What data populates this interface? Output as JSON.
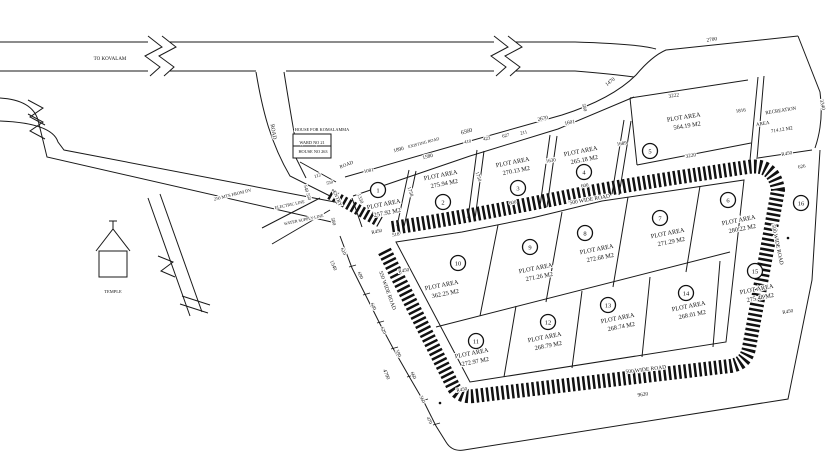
{
  "drawing_type": "land-subdivision-site-plan",
  "colors": {
    "ink": "#1a1a1a",
    "paper": "#ffffff"
  },
  "plot_area_label": "PLOT AREA",
  "plots": [
    {
      "n": "1",
      "area": "257.92 M2",
      "cx": 378,
      "cy": 190,
      "tx": 384,
      "ty": 206,
      "rot": -11
    },
    {
      "n": "2",
      "area": "275.94 M2",
      "cx": 443,
      "cy": 202,
      "tx": 441,
      "ty": 177,
      "rot": -11
    },
    {
      "n": "3",
      "area": "270.13 M2",
      "cx": 518,
      "cy": 188,
      "tx": 513,
      "ty": 164,
      "rot": -11
    },
    {
      "n": "4",
      "area": "265.18 M2",
      "cx": 584,
      "cy": 172,
      "tx": 581,
      "ty": 153,
      "rot": -11
    },
    {
      "n": "5",
      "area": "564.19 M2",
      "cx": 650,
      "cy": 151,
      "tx": 684,
      "ty": 119,
      "rot": -9
    },
    {
      "n": "6",
      "area": "280.22 M2",
      "cx": 728,
      "cy": 200,
      "tx": 739,
      "ty": 222,
      "rot": -11
    },
    {
      "n": "7",
      "area": "271.29 M2",
      "cx": 660,
      "cy": 218,
      "tx": 668,
      "ty": 235,
      "rot": -11
    },
    {
      "n": "8",
      "area": "272.68 M2",
      "cx": 585,
      "cy": 233,
      "tx": 597,
      "ty": 251,
      "rot": -11
    },
    {
      "n": "9",
      "area": "271.26 M2",
      "cx": 530,
      "cy": 247,
      "tx": 536,
      "ty": 270,
      "rot": -11
    },
    {
      "n": "10",
      "area": "362.25 M2",
      "cx": 458,
      "cy": 263,
      "tx": 442,
      "ty": 287,
      "rot": -11
    },
    {
      "n": "11",
      "area": "272.97 M2",
      "cx": 476,
      "cy": 341,
      "tx": 472,
      "ty": 355,
      "rot": -11
    },
    {
      "n": "12",
      "area": "268.79 M2",
      "cx": 548,
      "cy": 322,
      "tx": 545,
      "ty": 339,
      "rot": -11
    },
    {
      "n": "13",
      "area": "268.74 M2",
      "cx": 608,
      "cy": 305,
      "tx": 618,
      "ty": 320,
      "rot": -11
    },
    {
      "n": "14",
      "area": "268.01 M2",
      "cx": 686,
      "cy": 293,
      "tx": 689,
      "ty": 308,
      "rot": -11
    },
    {
      "n": "15",
      "area": "275.48 M2",
      "cx": 755,
      "cy": 271,
      "tx": 757,
      "ty": 291,
      "rot": -11
    },
    {
      "n": "16",
      "area": null,
      "cx": 801,
      "cy": 203
    }
  ],
  "annotations": [
    [
      "TO KOVALAM",
      110,
      60,
      0,
      5
    ],
    [
      "ROAD",
      272,
      132,
      80,
      5.5
    ],
    [
      "HOUSE FOR KOMALAMMA",
      322,
      131,
      0,
      4.3
    ],
    [
      "WARD NO 21",
      312,
      144,
      0,
      4.3
    ],
    [
      "HOUSE NO 263",
      313,
      153,
      0,
      4.3
    ],
    [
      "TEMPLE",
      113,
      293,
      0,
      4.5
    ],
    [
      "250 MTS FROM DV",
      233,
      196,
      -14,
      4.5
    ],
    [
      "ELECTRIC LINE",
      290,
      206,
      -12,
      4.2
    ],
    [
      "WATER SUPPLY LINE",
      304,
      221,
      -12,
      4.2
    ],
    [
      "ROAD",
      347,
      166,
      -22,
      5
    ],
    [
      "ENTRY",
      336,
      199,
      66,
      5
    ],
    [
      "540 550",
      306,
      193,
      73,
      4.8
    ],
    [
      "550",
      330,
      184,
      -15,
      4.5
    ],
    [
      "580",
      332,
      222,
      73,
      5
    ],
    [
      "112",
      318,
      177,
      -18,
      4.8
    ],
    [
      "1081",
      369,
      172,
      -12,
      5
    ],
    [
      "1330",
      359,
      199,
      70,
      5
    ],
    [
      "R450",
      377,
      233,
      -12,
      5
    ],
    [
      "518",
      396,
      236,
      -12,
      5
    ],
    [
      "1890",
      399,
      151,
      -15,
      5.3
    ],
    [
      "1580",
      428,
      158,
      -14,
      5.3
    ],
    [
      "EXISTING ROAD",
      424,
      144,
      -15,
      4.2
    ],
    [
      "6560",
      467,
      133,
      -15,
      5.8
    ],
    [
      "410",
      468,
      143,
      -13,
      4.8
    ],
    [
      "423",
      487,
      140,
      -13,
      4.8
    ],
    [
      "627",
      506,
      137,
      -13,
      4.8
    ],
    [
      "211",
      524,
      134,
      -13,
      4.8
    ],
    [
      "2670",
      543,
      120,
      -12,
      5.3
    ],
    [
      "1601",
      570,
      124,
      -12,
      5.3
    ],
    [
      "1470",
      611,
      83,
      -38,
      5.3
    ],
    [
      "2700",
      712,
      41,
      -8,
      5.3
    ],
    [
      "3222",
      674,
      97,
      -9,
      5.3
    ],
    [
      "3340",
      821,
      105,
      78,
      5.3
    ],
    [
      "1816",
      741,
      112,
      -9,
      5
    ],
    [
      "1689",
      622,
      145,
      -9,
      5
    ],
    [
      "1630",
      551,
      162,
      -9,
      5
    ],
    [
      "580",
      583,
      108,
      73,
      5
    ],
    [
      "1750",
      477,
      177,
      73,
      5
    ],
    [
      "1758",
      409,
      192,
      73,
      5
    ],
    [
      "600",
      513,
      204,
      -11,
      5
    ],
    [
      "600",
      585,
      187,
      -10,
      5
    ],
    [
      "3220",
      691,
      157,
      -9,
      5.3
    ],
    [
      "500 WIDE ROAD",
      590,
      201,
      -10,
      5.5
    ],
    [
      "500 WIDE ROAD",
      776,
      245,
      78,
      5.5
    ],
    [
      "550 WIDE ROAD",
      386,
      291,
      70,
      5.5
    ],
    [
      "500 WIDE ROAD",
      646,
      371,
      -7,
      5.5
    ],
    [
      "9620",
      643,
      396,
      -7,
      5.3
    ],
    [
      "R450",
      404,
      272,
      -10,
      5
    ],
    [
      "R450",
      787,
      155,
      -10,
      5
    ],
    [
      "626",
      802,
      168,
      -10,
      5
    ],
    [
      "R450",
      788,
      313,
      -10,
      5
    ],
    [
      "R450",
      462,
      391,
      -9,
      5
    ],
    [
      "610",
      342,
      252,
      66,
      5
    ],
    [
      "1540",
      332,
      266,
      66,
      5.3
    ],
    [
      "690",
      359,
      276,
      66,
      5
    ],
    [
      "640",
      372,
      307,
      66,
      5
    ],
    [
      "620",
      382,
      331,
      66,
      5
    ],
    [
      "590",
      397,
      354,
      66,
      5
    ],
    [
      "4790",
      385,
      375,
      66,
      5.3
    ],
    [
      "660",
      412,
      376,
      66,
      5
    ],
    [
      "560",
      421,
      400,
      66,
      5
    ],
    [
      "470",
      428,
      421,
      66,
      5
    ],
    [
      "RECREATION",
      781,
      112,
      -9,
      5
    ],
    [
      "AREA",
      763,
      125,
      -9,
      5
    ],
    [
      "714.12 M2",
      782,
      131,
      -9,
      5
    ]
  ]
}
